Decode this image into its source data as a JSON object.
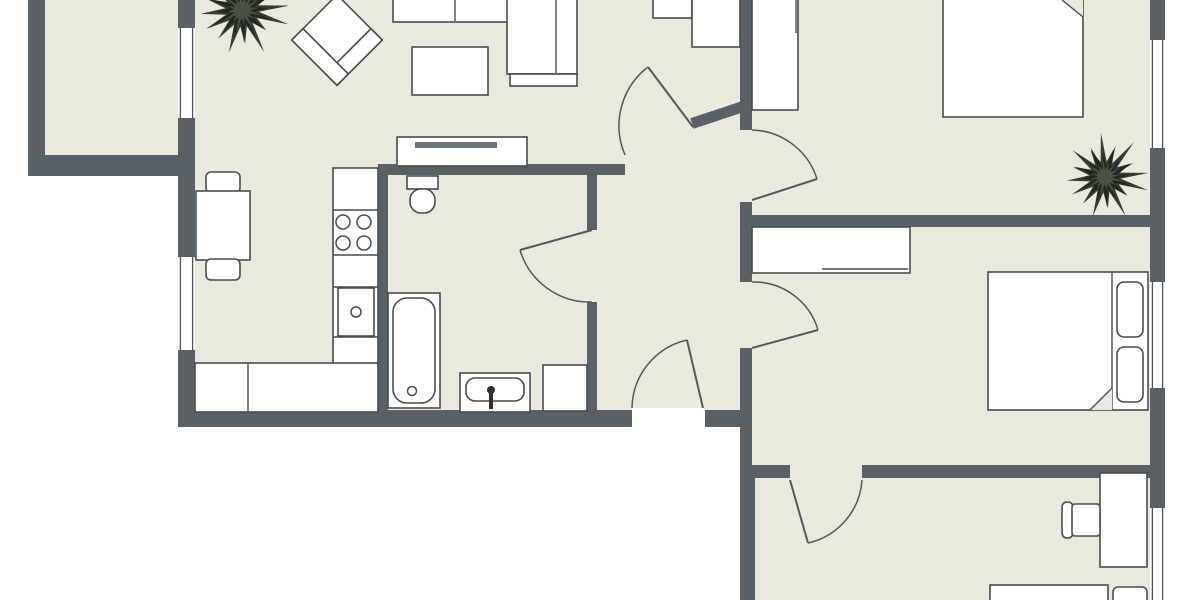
{
  "plan": {
    "title": "apartment-floor-plan",
    "canvas": {
      "width": 1200,
      "height": 600
    },
    "colors": {
      "floor": "#e9e9dd",
      "wall": "#596066",
      "outline": "#474c50",
      "thin_line": "#6f7478",
      "door": "#54595e",
      "window_line": "#4f545a",
      "tv": "#70757a",
      "fixture_dark": "#2e3233",
      "plant_outer": "#2e342c",
      "plant_mid": "#20251f",
      "plant_core": "#4b5342",
      "white": "#ffffff"
    },
    "rooms": [
      {
        "name": "balcony-floor",
        "x": 45,
        "y": 0,
        "w": 133,
        "h": 160
      },
      {
        "name": "main-interior-floor",
        "x": 195,
        "y": 0,
        "w": 955,
        "h": 415
      },
      {
        "name": "lower-bedrooms-floor",
        "x": 752,
        "y": 410,
        "w": 398,
        "h": 190
      }
    ],
    "walls": [
      {
        "name": "wall-balcony-left",
        "x": 28,
        "y": 0,
        "w": 17,
        "h": 176
      },
      {
        "name": "wall-balcony-bottom",
        "x": 28,
        "y": 155,
        "w": 154,
        "h": 21
      },
      {
        "name": "wall-left-top",
        "x": 178,
        "y": 0,
        "w": 17,
        "h": 28
      },
      {
        "name": "wall-left-middle",
        "x": 178,
        "y": 118,
        "w": 17,
        "h": 139
      },
      {
        "name": "wall-left-lower",
        "x": 178,
        "y": 350,
        "w": 17,
        "h": 77
      },
      {
        "name": "wall-bottom-main",
        "x": 178,
        "y": 410,
        "w": 454,
        "h": 17
      },
      {
        "name": "wall-bottom-entry-right",
        "x": 705,
        "y": 410,
        "w": 47,
        "h": 17
      },
      {
        "name": "wall-hall-right-top",
        "x": 740,
        "y": 0,
        "w": 12,
        "h": 130
      },
      {
        "name": "wall-hall-right-mid",
        "x": 740,
        "y": 202,
        "w": 12,
        "h": 80
      },
      {
        "name": "wall-hall-right-low",
        "x": 740,
        "y": 348,
        "w": 12,
        "h": 120
      },
      {
        "name": "wall-right-lower-vert",
        "x": 740,
        "y": 465,
        "w": 15,
        "h": 135
      },
      {
        "name": "wall-bed1-bed2",
        "x": 752,
        "y": 215,
        "w": 413,
        "h": 12
      },
      {
        "name": "wall-bed2-bed3-left",
        "x": 752,
        "y": 465,
        "w": 38,
        "h": 13
      },
      {
        "name": "wall-bed2-bed3-right",
        "x": 862,
        "y": 465,
        "w": 303,
        "h": 13
      },
      {
        "name": "wall-outer-right-a",
        "x": 1150,
        "y": 0,
        "w": 15,
        "h": 40
      },
      {
        "name": "wall-outer-right-b",
        "x": 1150,
        "y": 148,
        "w": 15,
        "h": 134
      },
      {
        "name": "wall-outer-right-c",
        "x": 1150,
        "y": 388,
        "w": 15,
        "h": 120
      },
      {
        "name": "wall-bath-top",
        "x": 378,
        "y": 164,
        "w": 247,
        "h": 11
      },
      {
        "name": "wall-kitchen-bath",
        "x": 378,
        "y": 164,
        "w": 10,
        "h": 263
      },
      {
        "name": "wall-bath-hall-top",
        "x": 587,
        "y": 164,
        "w": 10,
        "h": 66
      },
      {
        "name": "wall-bath-hall-bottom",
        "x": 587,
        "y": 302,
        "w": 10,
        "h": 125
      }
    ],
    "diagonal_walls": [
      {
        "name": "wall-hall-diagonal",
        "x": 692,
        "y": 118,
        "w": 58,
        "h": 11,
        "a": -18.4,
        "cx": 692,
        "cy": 123.5
      }
    ],
    "thresholds": [
      {
        "name": "entry-door-threshold",
        "x": 632,
        "y": 408,
        "w": 73,
        "h": 19
      }
    ],
    "windows": [
      {
        "name": "window-balcony",
        "x": 178,
        "y": 28,
        "w": 17,
        "h": 90
      },
      {
        "name": "window-kitchen",
        "x": 178,
        "y": 257,
        "w": 17,
        "h": 93
      },
      {
        "name": "window-bedroom1",
        "x": 1150,
        "y": 40,
        "w": 15,
        "h": 108
      },
      {
        "name": "window-bedroom2",
        "x": 1150,
        "y": 282,
        "w": 15,
        "h": 106
      },
      {
        "name": "window-bedroom3",
        "x": 1150,
        "y": 508,
        "w": 15,
        "h": 92
      }
    ],
    "doors": [
      {
        "name": "door-living-hall",
        "leaf": [
          693,
          127,
          648,
          67
        ],
        "arc": {
          "sx": 648,
          "sy": 67,
          "ex": 625,
          "ey": 155,
          "r": 74,
          "sweep": 0
        }
      },
      {
        "name": "door-bathroom",
        "leaf": [
          592,
          230,
          520,
          250
        ],
        "arc": {
          "sx": 520,
          "sy": 250,
          "ex": 592,
          "ey": 302,
          "r": 73,
          "sweep": 0
        }
      },
      {
        "name": "door-bedroom1",
        "leaf": [
          752,
          200,
          817,
          179
        ],
        "arc": {
          "sx": 752,
          "sy": 130,
          "ex": 817,
          "ey": 179,
          "r": 70,
          "sweep": 1
        }
      },
      {
        "name": "door-bedroom2",
        "leaf": [
          752,
          348,
          818,
          330
        ],
        "arc": {
          "sx": 752,
          "sy": 282,
          "ex": 818,
          "ey": 330,
          "r": 67,
          "sweep": 1
        }
      },
      {
        "name": "door-entry",
        "leaf": [
          703,
          408,
          687,
          340
        ],
        "arc": {
          "sx": 632,
          "sy": 408,
          "ex": 687,
          "ey": 340,
          "r": 71,
          "sweep": 1
        }
      },
      {
        "name": "door-bedroom3",
        "leaf": [
          790,
          480,
          808,
          543
        ],
        "arc": {
          "sx": 862,
          "sy": 480,
          "ex": 808,
          "ey": 543,
          "r": 69,
          "sweep": 1
        }
      }
    ],
    "furniture": [
      {
        "name": "sofa-seats",
        "t": "rect",
        "x": 393,
        "y": -4,
        "w": 117,
        "h": 26
      },
      {
        "name": "sofa-seat-divider",
        "t": "line",
        "x1": 455,
        "y1": -2,
        "x2": 455,
        "y2": 21
      },
      {
        "name": "sofa-corner-section",
        "t": "rect",
        "x": 507,
        "y": -4,
        "w": 70,
        "h": 78
      },
      {
        "name": "sofa-armrest-divider",
        "t": "line",
        "x1": 556,
        "y1": -2,
        "x2": 556,
        "y2": 73
      },
      {
        "name": "sofa-front-armrest",
        "t": "rect",
        "x": 510,
        "y": 74,
        "w": 67,
        "h": 12
      },
      {
        "name": "coffee-table",
        "t": "rect",
        "x": 412,
        "y": 47,
        "w": 76,
        "h": 48
      },
      {
        "name": "armchair-seat",
        "t": "rotrect",
        "x": 305,
        "y": 8,
        "w": 64,
        "h": 64,
        "a": 45,
        "cx": 337,
        "cy": 40
      },
      {
        "name": "armchair-armrest-a",
        "t": "rotrect",
        "x": 353,
        "y": 8,
        "w": 16,
        "h": 64,
        "a": 45,
        "cx": 337,
        "cy": 40
      },
      {
        "name": "armchair-armrest-b",
        "t": "rotrect",
        "x": 305,
        "y": 56,
        "w": 64,
        "h": 16,
        "a": 45,
        "cx": 337,
        "cy": 40
      },
      {
        "name": "tv-bench",
        "t": "rect",
        "x": 397,
        "y": 137,
        "w": 130,
        "h": 29
      },
      {
        "name": "tv",
        "t": "rect",
        "x": 415,
        "y": 142,
        "w": 82,
        "h": 6,
        "fill": "tv",
        "stroke": "none"
      },
      {
        "name": "hall-cabinet-small",
        "t": "rect",
        "x": 653,
        "y": -4,
        "w": 39,
        "h": 22
      },
      {
        "name": "hall-cabinet-tall",
        "t": "rect",
        "x": 692,
        "y": -4,
        "w": 48,
        "h": 51
      },
      {
        "name": "dining-chair-top",
        "t": "rect",
        "x": 206,
        "y": 172,
        "w": 34,
        "h": 21,
        "rx": 5
      },
      {
        "name": "dining-table",
        "t": "rect",
        "x": 196,
        "y": 191,
        "w": 54,
        "h": 69
      },
      {
        "name": "dining-chair-bottom",
        "t": "rect",
        "x": 206,
        "y": 259,
        "w": 34,
        "h": 21,
        "rx": 5
      },
      {
        "name": "kitchen-counter-column",
        "t": "rect",
        "x": 333,
        "y": 168,
        "w": 45,
        "h": 197
      },
      {
        "name": "kitchen-counter-line-1",
        "t": "line",
        "x1": 333,
        "y1": 210,
        "x2": 378,
        "y2": 210
      },
      {
        "name": "kitchen-counter-line-2",
        "t": "line",
        "x1": 333,
        "y1": 255,
        "x2": 378,
        "y2": 255
      },
      {
        "name": "kitchen-counter-line-3",
        "t": "line",
        "x1": 333,
        "y1": 287,
        "x2": 378,
        "y2": 287
      },
      {
        "name": "kitchen-counter-line-4",
        "t": "line",
        "x1": 333,
        "y1": 337,
        "x2": 378,
        "y2": 337
      },
      {
        "name": "stove-burner-1",
        "t": "circle",
        "cx": 343,
        "cy": 222,
        "r": 7
      },
      {
        "name": "stove-burner-2",
        "t": "circle",
        "cx": 364,
        "cy": 222,
        "r": 7
      },
      {
        "name": "stove-burner-3",
        "t": "circle",
        "cx": 343,
        "cy": 243,
        "r": 7
      },
      {
        "name": "stove-burner-4",
        "t": "circle",
        "cx": 364,
        "cy": 243,
        "r": 7
      },
      {
        "name": "kitchen-sink-cabinet",
        "t": "rect",
        "x": 338,
        "y": 288,
        "w": 36,
        "h": 48
      },
      {
        "name": "kitchen-sink-drain",
        "t": "circle",
        "cx": 356,
        "cy": 312,
        "r": 5
      },
      {
        "name": "kitchen-lower-cabinets",
        "t": "rect",
        "x": 195,
        "y": 363,
        "w": 183,
        "h": 49
      },
      {
        "name": "kitchen-cabinet-divider",
        "t": "line",
        "x1": 248,
        "y1": 363,
        "x2": 248,
        "y2": 412
      },
      {
        "name": "toilet-tank",
        "t": "rect",
        "x": 407,
        "y": 176,
        "w": 31,
        "h": 13
      },
      {
        "name": "toilet-bowl",
        "t": "rect",
        "x": 410,
        "y": 189,
        "w": 25,
        "h": 24,
        "rx": 11
      },
      {
        "name": "bathtub",
        "t": "rect",
        "x": 388,
        "y": 293,
        "w": 52,
        "h": 115
      },
      {
        "name": "bathtub-inner",
        "t": "rect",
        "x": 393,
        "y": 298,
        "w": 42,
        "h": 105,
        "rx": 14
      },
      {
        "name": "bathtub-drain",
        "t": "circle",
        "cx": 412,
        "cy": 391,
        "r": 4.5
      },
      {
        "name": "bathroom-sink-unit",
        "t": "rect",
        "x": 460,
        "y": 373,
        "w": 70,
        "h": 39
      },
      {
        "name": "bathroom-sink-basin",
        "t": "rect",
        "x": 466,
        "y": 378,
        "w": 58,
        "h": 23,
        "rx": 9
      },
      {
        "name": "sink-faucet-dot",
        "t": "circle",
        "cx": 491,
        "cy": 390,
        "r": 4,
        "fill": "fixture_dark",
        "stroke": "none"
      },
      {
        "name": "sink-faucet-stem",
        "t": "rect",
        "x": 489,
        "y": 393,
        "w": 4,
        "h": 16,
        "fill": "fixture_dark",
        "stroke": "none"
      },
      {
        "name": "washing-machine",
        "t": "rect",
        "x": 543,
        "y": 365,
        "w": 44,
        "h": 46
      },
      {
        "name": "bedroom1-wardrobe",
        "t": "rect",
        "x": 752,
        "y": -4,
        "w": 46,
        "h": 114
      },
      {
        "name": "bedroom1-wardrobe-line",
        "t": "line",
        "x1": 796,
        "y1": 0,
        "x2": 796,
        "y2": 33
      },
      {
        "name": "bedroom1-bed",
        "t": "rect",
        "x": 943,
        "y": -6,
        "w": 140,
        "h": 123
      },
      {
        "name": "bedroom1-bed-fold-cut",
        "t": "polygon",
        "points": "1062,0 1083,0 1083,17",
        "fill": "floor",
        "stroke": "none"
      },
      {
        "name": "bedroom1-bed-fold-line",
        "t": "line",
        "x1": 1062,
        "y1": 0,
        "x2": 1083,
        "y2": 17
      },
      {
        "name": "bedroom2-wardrobe",
        "t": "rect",
        "x": 752,
        "y": 227,
        "w": 158,
        "h": 46
      },
      {
        "name": "bedroom2-wardrobe-line",
        "t": "line",
        "x1": 822,
        "y1": 269,
        "x2": 908,
        "y2": 269
      },
      {
        "name": "bedroom2-bed",
        "t": "rect",
        "x": 988,
        "y": 272,
        "w": 160,
        "h": 138
      },
      {
        "name": "bedroom2-bed-headline",
        "t": "line",
        "x1": 1112,
        "y1": 272,
        "x2": 1112,
        "y2": 410
      },
      {
        "name": "bedroom2-pillow-a",
        "t": "rect",
        "x": 1117,
        "y": 282,
        "w": 26,
        "h": 55,
        "rx": 7
      },
      {
        "name": "bedroom2-pillow-b",
        "t": "rect",
        "x": 1117,
        "y": 347,
        "w": 26,
        "h": 55,
        "rx": 7
      },
      {
        "name": "bedroom2-bed-fold-cut",
        "t": "polygon",
        "points": "1112,388 1112,410 1090,410",
        "fill": "floor",
        "stroke": "none"
      },
      {
        "name": "bedroom2-bed-fold-line",
        "t": "line",
        "x1": 1090,
        "y1": 410,
        "x2": 1112,
        "y2": 388
      },
      {
        "name": "bedroom3-desk",
        "t": "rect",
        "x": 1100,
        "y": 473,
        "w": 47,
        "h": 94
      },
      {
        "name": "bedroom3-chair-back",
        "t": "rect",
        "x": 1062,
        "y": 502,
        "w": 11,
        "h": 36,
        "rx": 5
      },
      {
        "name": "bedroom3-chair-seat",
        "t": "rect",
        "x": 1072,
        "y": 504,
        "w": 28,
        "h": 32,
        "rx": 3
      },
      {
        "name": "bedroom3-bed",
        "t": "rect",
        "x": 990,
        "y": 585,
        "w": 118,
        "h": 20
      },
      {
        "name": "bedroom3-nightstand",
        "t": "rect",
        "x": 1113,
        "y": 587,
        "w": 34,
        "h": 18,
        "rx": 5
      }
    ],
    "plants": [
      {
        "name": "plant-living-room",
        "cx": 242,
        "cy": 10,
        "r": 40
      },
      {
        "name": "plant-bedroom1",
        "cx": 1105,
        "cy": 177,
        "r": 37
      }
    ]
  }
}
